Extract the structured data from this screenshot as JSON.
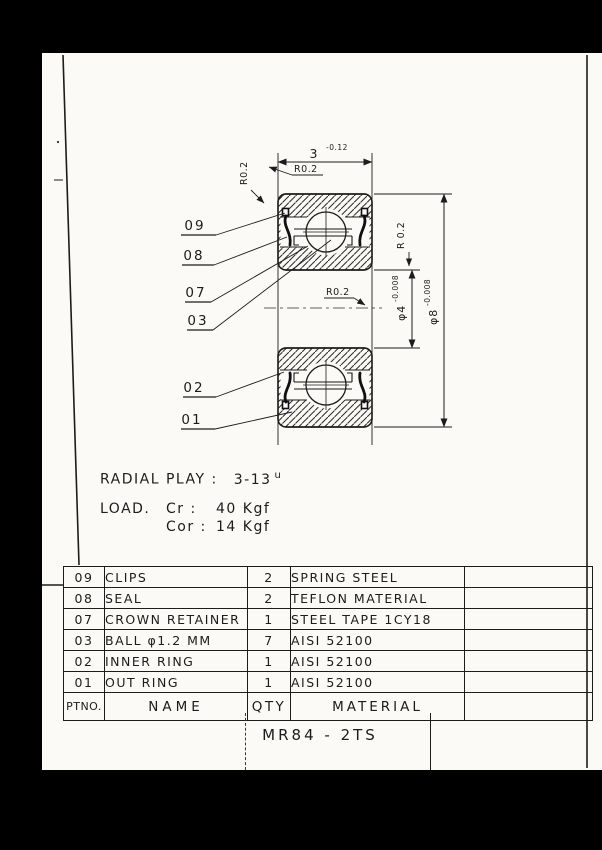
{
  "page": {
    "paper_color": "#fbfaf7",
    "ink_color": "#1c1c1c",
    "background_color": "#000000"
  },
  "drawing": {
    "width_dim": {
      "value": "3",
      "tolerance": "-0.12"
    },
    "radius_callouts": [
      "R0.2",
      "R0.2",
      "R 0.2",
      "R0.2"
    ],
    "bore_dim": {
      "value": "φ4",
      "tolerance": "-0.008"
    },
    "outer_dim": {
      "value": "φ8",
      "tolerance": "-0.008"
    },
    "part_labels": [
      {
        "id": "09"
      },
      {
        "id": "08"
      },
      {
        "id": "07"
      },
      {
        "id": "03"
      },
      {
        "id": "02"
      },
      {
        "id": "01"
      }
    ]
  },
  "notes": {
    "radial_play_label": "RADIAL PLAY :",
    "radial_play_value": "3-13",
    "radial_play_unit": "u",
    "load_label": "LOAD.",
    "load_rows": [
      {
        "name": "Cr :",
        "value": "40 Kgf"
      },
      {
        "name": "Cor :",
        "value": "14 Kgf"
      }
    ]
  },
  "parts_table": {
    "headers": {
      "ptno": "PTNO.",
      "name": "NAME",
      "qty": "QTY",
      "material": "MATERIAL"
    },
    "rows": [
      {
        "ptno": "09",
        "name": "CLIPS",
        "qty": "2",
        "material": "SPRING STEEL"
      },
      {
        "ptno": "08",
        "name": "SEAL",
        "qty": "2",
        "material": "TEFLON MATERIAL"
      },
      {
        "ptno": "07",
        "name": "CROWN RETAINER",
        "qty": "1",
        "material": "STEEL TAPE 1CY18"
      },
      {
        "ptno": "03",
        "name": "BALL φ1.2 MM",
        "qty": "7",
        "material": "AISI 52100"
      },
      {
        "ptno": "02",
        "name": "INNER RING",
        "qty": "1",
        "material": "AISI 52100"
      },
      {
        "ptno": "01",
        "name": "OUT RING",
        "qty": "1",
        "material": "AISI 52100"
      }
    ]
  },
  "title_block": {
    "part_number": "MR84 - 2TS"
  }
}
